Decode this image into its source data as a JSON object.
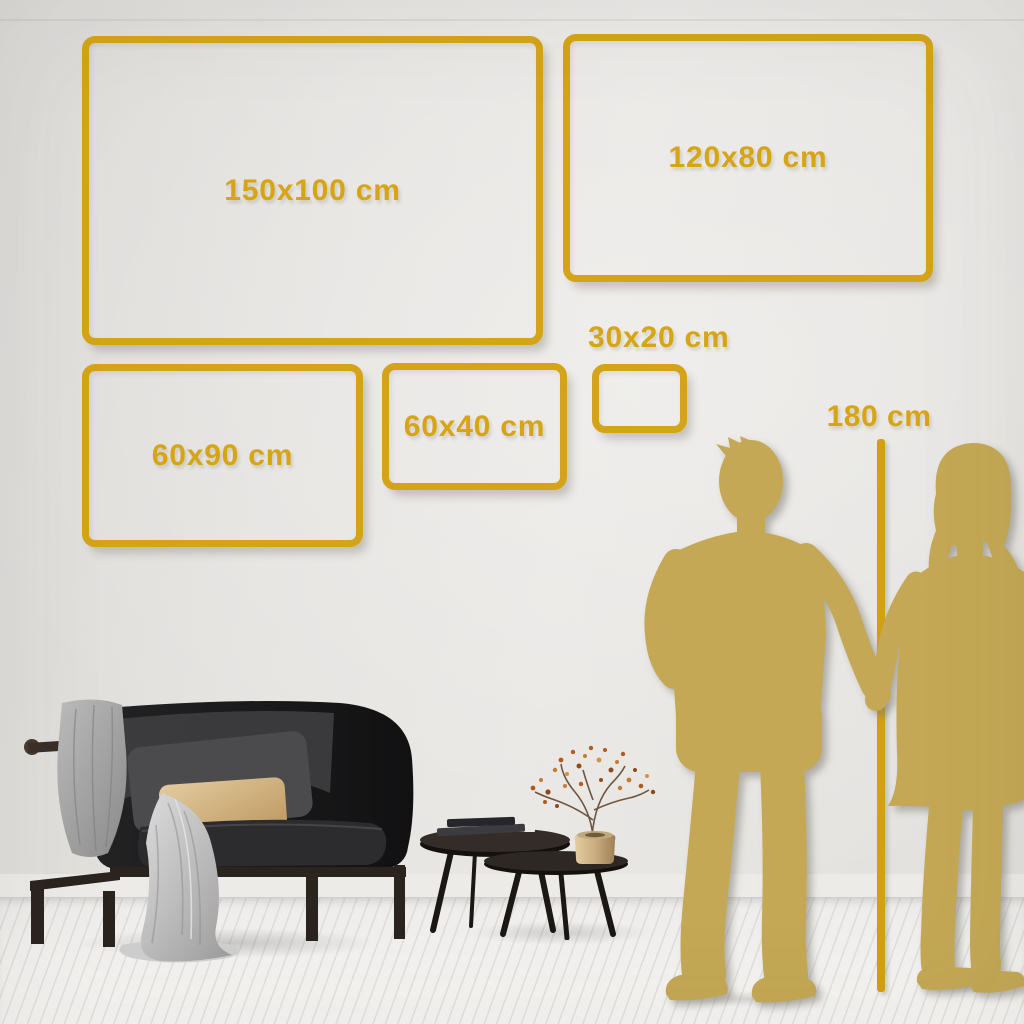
{
  "size_guide": {
    "frames": [
      {
        "id": "150x100",
        "label": "150x100 cm",
        "width_cm": 150,
        "height_cm": 100
      },
      {
        "id": "120x80",
        "label": "120x80 cm",
        "width_cm": 120,
        "height_cm": 80
      },
      {
        "id": "60x90",
        "label": "60x90 cm",
        "width_cm": 60,
        "height_cm": 90
      },
      {
        "id": "60x40",
        "label": "60x40 cm",
        "width_cm": 60,
        "height_cm": 40
      },
      {
        "id": "30x20",
        "label": "30x20 cm",
        "width_cm": 30,
        "height_cm": 20
      }
    ],
    "height_reference": {
      "label": "180 cm",
      "height_cm": 180
    },
    "colors": {
      "accent_gold": "#d7a414",
      "frame_gold": "#d4a317",
      "silhouette_gold": "#c4a855",
      "wall": "#e4e2df",
      "floor": "#f2f1ef"
    }
  },
  "scene": {
    "items": [
      "couple-silhouette",
      "height-reference-line",
      "sofa",
      "throw-blanket",
      "draped-cloth",
      "gray-cushion",
      "tan-cushion",
      "nesting-coffee-tables",
      "books-stack",
      "brass-vase-with-dried-branch",
      "plank-floor"
    ]
  }
}
